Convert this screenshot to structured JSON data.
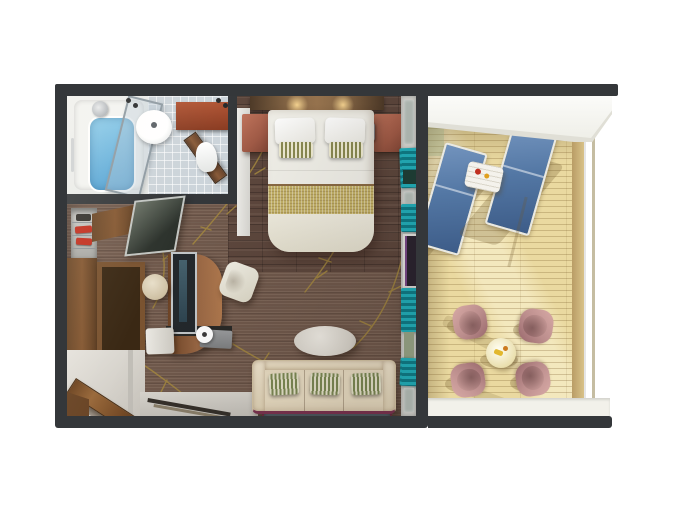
{
  "scene": {
    "type": "3d-floorplan-render",
    "view": "top-down",
    "description": "Top-down 3D rendering of a suite with bathroom, bedroom, living area and private veranda"
  },
  "palette": {
    "background": "#ffffff",
    "wall": "#34373a",
    "carpet": "#70594c",
    "bedroom_floor": "#5d473d",
    "gold_vine": "#a5893f",
    "bath_tile": "#ccd4da",
    "bath_water": "#8ecdeb",
    "linen_white": "#f2f1ea",
    "bed_runner": "#c4b268",
    "nightstand_wood": "#a05a46",
    "teal_curtain": "#22b2be",
    "wardrobe_wood": "#855832",
    "cabinet_interior": "#3a2814",
    "tv_dark": "#23282c",
    "stool_beige": "#cfc1a4",
    "chair_cream": "#ddd9c8",
    "table_oval": "#d9d5cc",
    "sofa_cream": "#ebdfc5",
    "pillow_green": "#7d8a55",
    "rug_blue": "#5e7383",
    "rug_border": "#7c3350",
    "deck_wood": "#ead9a0",
    "lounger_blue": "#5377a4",
    "lounger_frame": "#e9e9e3",
    "chair_mauve": "#bb8d8c",
    "patio_table": "#eadfae",
    "overhang": "#efefe8",
    "red_accent": "#c23020"
  },
  "rooms": {
    "bathroom": {
      "furniture": [
        "bathtub",
        "shower-screen",
        "washbasin",
        "toilet",
        "vanity-cabinet",
        "door"
      ]
    },
    "bedroom": {
      "furniture": [
        "double-bed",
        "white-pillows",
        "striped-accent-pillows",
        "gold-bed-runner",
        "nightstand-left",
        "nightstand-right",
        "reading-lamps",
        "headboard-with-lights"
      ]
    },
    "living_area": {
      "furniture": [
        "closet-shelves",
        "wardrobe",
        "open-cabinet",
        "leaning-mirror",
        "desk-with-tv",
        "stool",
        "desk-chair",
        "oval-coffee-table",
        "three-seat-sofa",
        "green-striped-pillows",
        "rug",
        "entry-door",
        "glass-wall-with-teal-curtains"
      ]
    },
    "veranda": {
      "furniture": [
        "sun-lounger-left",
        "sun-lounger-right",
        "side-table",
        "round-dining-table",
        "patio-chair-1",
        "patio-chair-2",
        "patio-chair-3",
        "patio-chair-4",
        "glass-railing",
        "deck-planks",
        "overhang"
      ]
    }
  }
}
